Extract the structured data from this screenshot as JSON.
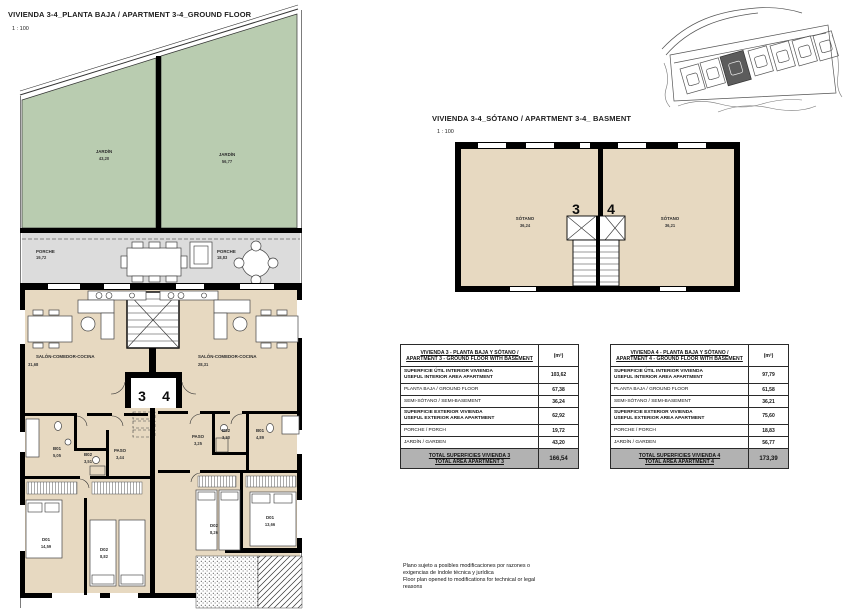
{
  "colors": {
    "garden_green": "#b9ccb0",
    "interior_beige": "#e7d9c1",
    "porch_gray": "#dcdcdc",
    "wall_black": "#000000",
    "total_row_gray": "#b2b2b2",
    "site_highlight": "#5c5c5c"
  },
  "ground_floor": {
    "title": "VIVIENDA 3-4_PLANTA BAJA / APARTMENT 3-4_GROUND FLOOR",
    "scale": "1 : 100",
    "unit_left": "3",
    "unit_right": "4",
    "garden_left": {
      "name": "JARDÍN",
      "area": "43,20"
    },
    "garden_right": {
      "name": "JARDÍN",
      "area": "56,77"
    },
    "porch_left": {
      "name": "PORCHE",
      "area": "19,72"
    },
    "porch_right": {
      "name": "PORCHE",
      "area": "18,83"
    },
    "living_left": {
      "name": "SALÓN-COMEDOR-COCINA",
      "area": "31,68"
    },
    "living_right": {
      "name": "SALÓN-COMEDOR-COCINA",
      "area": "28,31"
    },
    "b01_left": {
      "name": "B01",
      "area": "5,05"
    },
    "b02_left": {
      "name": "B02",
      "area": "3,51"
    },
    "paso_left": {
      "name": "PASO",
      "area": "3,44"
    },
    "d01_left": {
      "name": "D01",
      "area": "14,59"
    },
    "d02_left": {
      "name": "D02",
      "area": "8,82"
    },
    "paso_right": {
      "name": "PASO",
      "area": "3,25"
    },
    "b02_right": {
      "name": "B02",
      "area": "3,30"
    },
    "b01_right": {
      "name": "B01",
      "area": "4,89"
    },
    "d02_right": {
      "name": "D02",
      "area": "8,26"
    },
    "d01_right": {
      "name": "D01",
      "area": "13,66"
    }
  },
  "basement": {
    "title": "VIVIENDA 3-4_SÓTANO / APARTMENT 3-4_ BASMENT",
    "scale": "1 : 100",
    "unit_left": "3",
    "unit_right": "4",
    "room_left": {
      "name": "SÓTANO",
      "area": "36,24"
    },
    "room_right": {
      "name": "SÓTANO",
      "area": "36,21"
    }
  },
  "tables": {
    "unit": "(m²)",
    "v3": {
      "header1": "VIVIENDA 3 - PLANTA BAJA Y SÓTANO /",
      "header2": "APARTMENT 3 - GROUND FLOOR WITH BASEMENT",
      "rows": [
        {
          "l1": "SUPERFICIE ÚTIL INTERIOR VIVIENDA",
          "l2": "USEFUL INTERIOR AREA APARTMENT",
          "v": "103,62"
        },
        {
          "l1": "PLANTA BAJA / GROUND FLOOR",
          "v": "67,38"
        },
        {
          "l1": "SEMI-SÓTANO / SEMI-BASEMENT",
          "v": "36,24"
        },
        {
          "l1": "SUPERFICIE EXTERIOR VIVIENDA",
          "l2": "USEFUL EXTERIOR AREA APARTMENT",
          "v": "62,92"
        },
        {
          "l1": "PORCHE / PORCH",
          "v": "19,72"
        },
        {
          "l1": "JARDÍN / GARDEN",
          "v": "43,20"
        }
      ],
      "total1": "TOTAL SUPERFICIES VIVIENDA 3",
      "total2": "TOTAL AREA APARTMENT 3",
      "total_value": "166,54"
    },
    "v4": {
      "header1": "VIVIENDA 4 - PLANTA BAJA Y SÓTANO /",
      "header2": "APARTMENT 4 - GROUND FLOOR WITH BASEMENT",
      "rows": [
        {
          "l1": "SUPERFICIE ÚTIL INTERIOR VIVIENDA",
          "l2": "USEFUL INTERIOR AREA APARTMENT",
          "v": "97,79"
        },
        {
          "l1": "PLANTA BAJA / GROUND FLOOR",
          "v": "61,58"
        },
        {
          "l1": "SEMI-SÓTANO / SEMI-BASEMENT",
          "v": "36,21"
        },
        {
          "l1": "SUPERFICIE EXTERIOR VIVIENDA",
          "l2": "USEFUL EXTERIOR AREA APARTMENT",
          "v": "75,60"
        },
        {
          "l1": "PORCHE / PORCH",
          "v": "18,83"
        },
        {
          "l1": "JARDÍN / GARDEN",
          "v": "56,77"
        }
      ],
      "total1": "TOTAL SUPERFICIES VIVIENDA 4",
      "total2": "TOTAL AREA APARTMENT 4",
      "total_value": "173,39"
    }
  },
  "disclaimer": {
    "line1": "Plano sujeto a posibles modificaciones por razones o",
    "line2": "exigencias de índole técnica y jurídica",
    "line3": "Floor plan opened to modifications for technical or legal",
    "line4": "reasons"
  }
}
